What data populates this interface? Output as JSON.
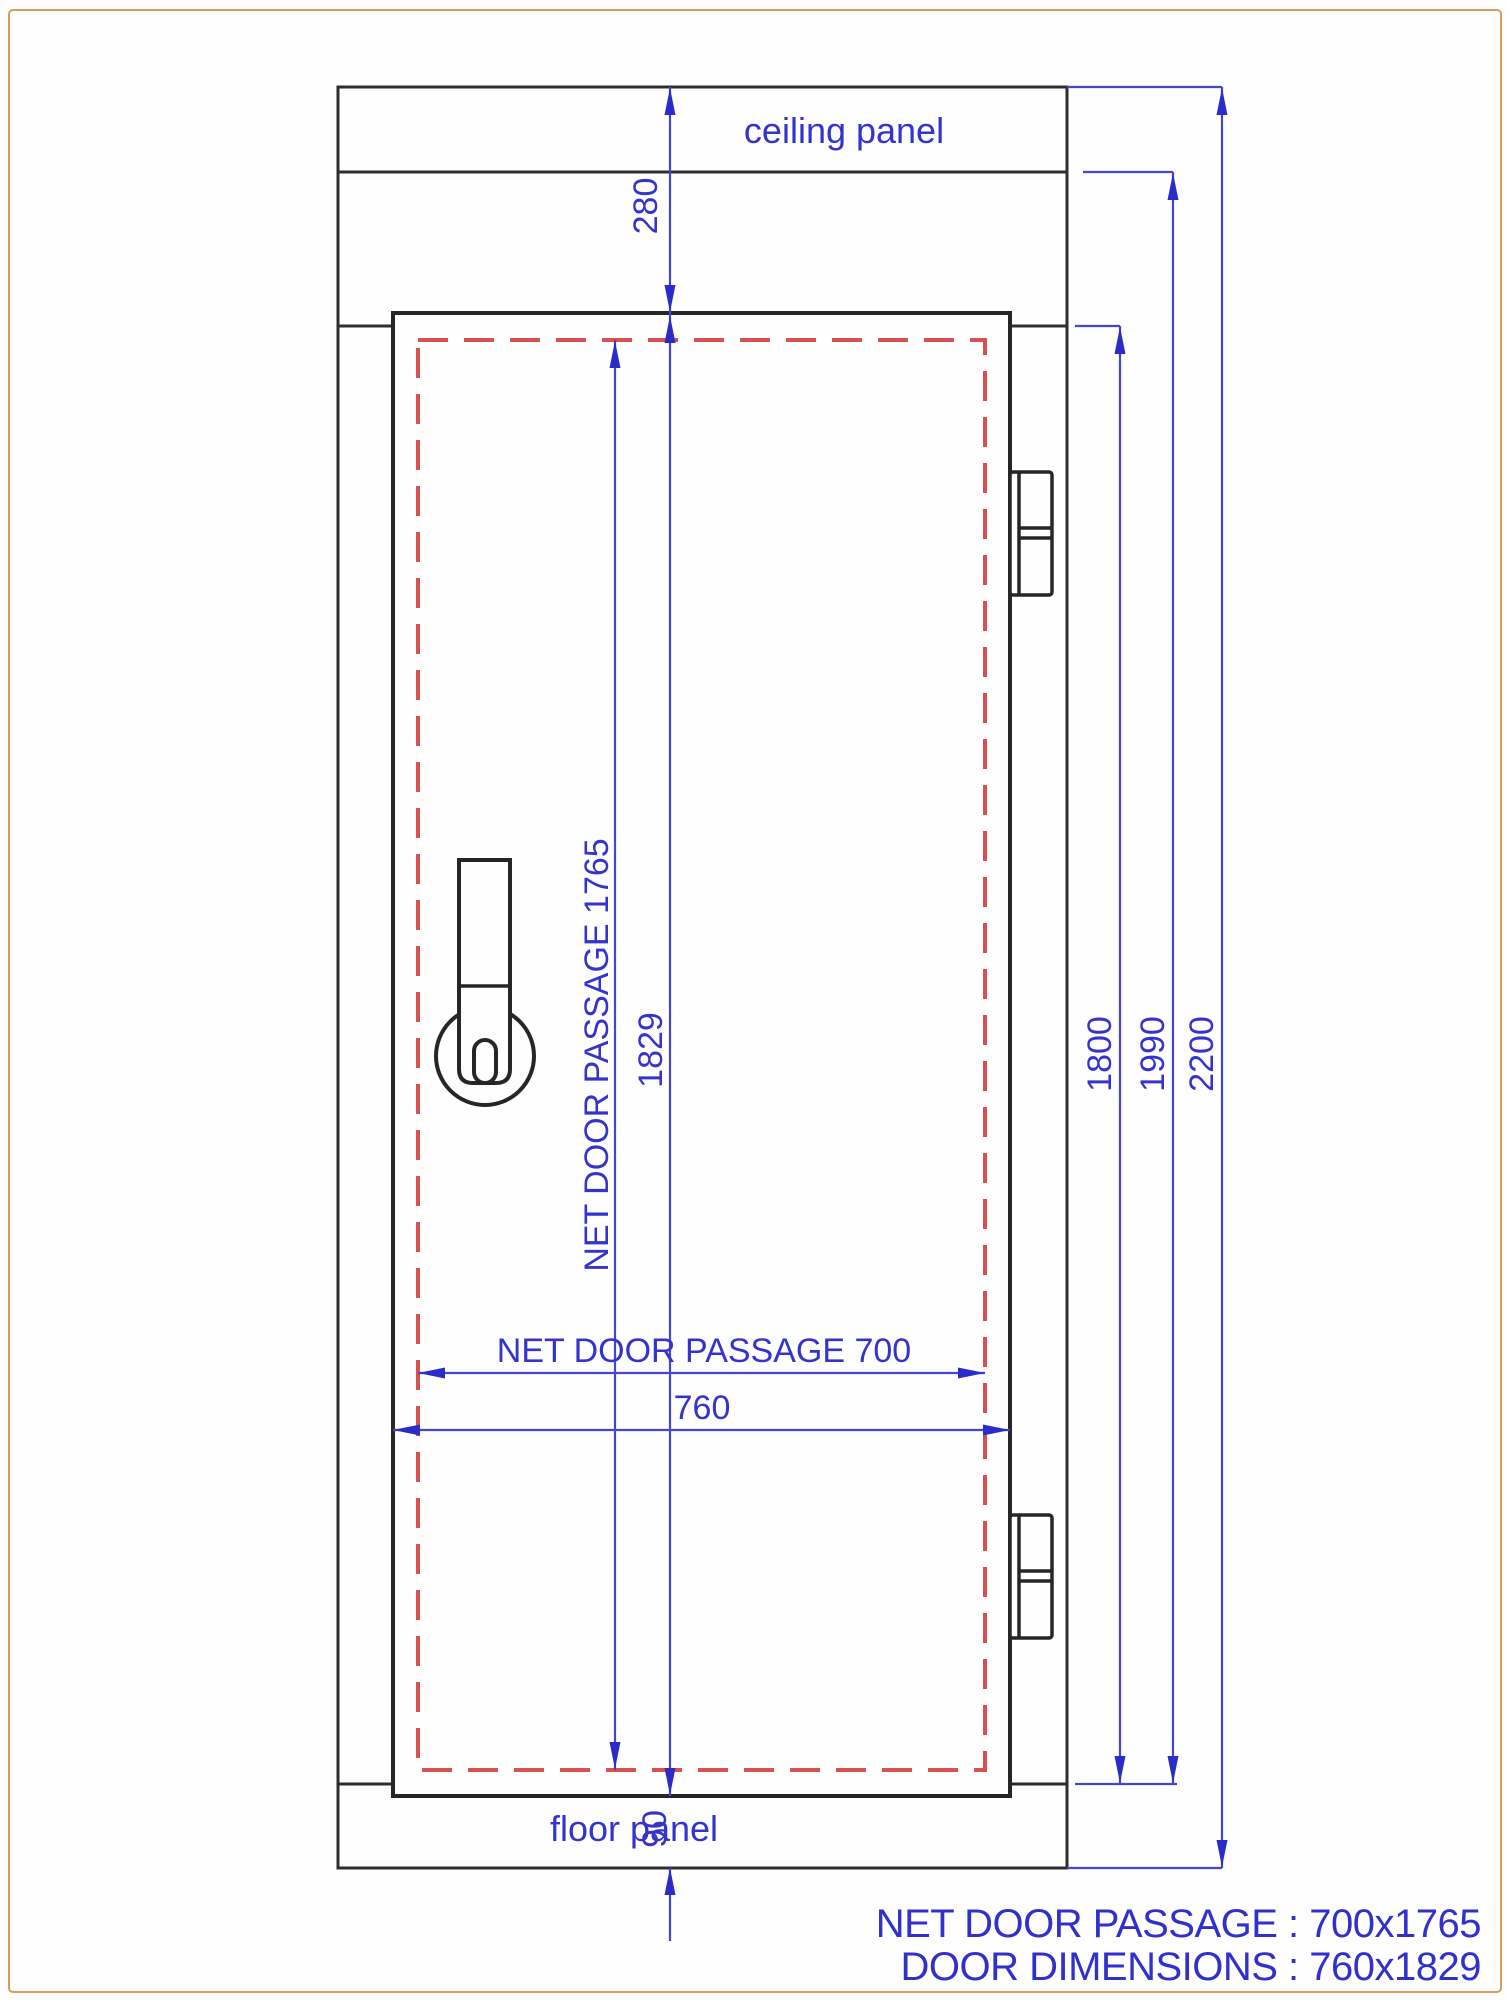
{
  "drawing": {
    "wall_labels": {
      "ceiling": "ceiling panel",
      "floor": "floor panel"
    },
    "dims": {
      "ceiling_offset": "280",
      "net_passage_height": "NET DOOR PASSAGE 1765",
      "door_height": "1829",
      "floor_offset": "90",
      "opening_height": "1800",
      "wall_inner_height": "1990",
      "total_height": "2200",
      "net_passage_width": "NET DOOR PASSAGE 700",
      "door_width": "760"
    },
    "summary": {
      "net_door_passage": "NET DOOR PASSAGE : 700x1765",
      "door_dimensions": "DOOR DIMENSIONS : 760x1829"
    },
    "colors": {
      "dimension_blue": "#3434cc",
      "drawing_black": "#2e2e2e",
      "passage_red": "#d95050",
      "frame_orange": "#d69c58"
    }
  }
}
